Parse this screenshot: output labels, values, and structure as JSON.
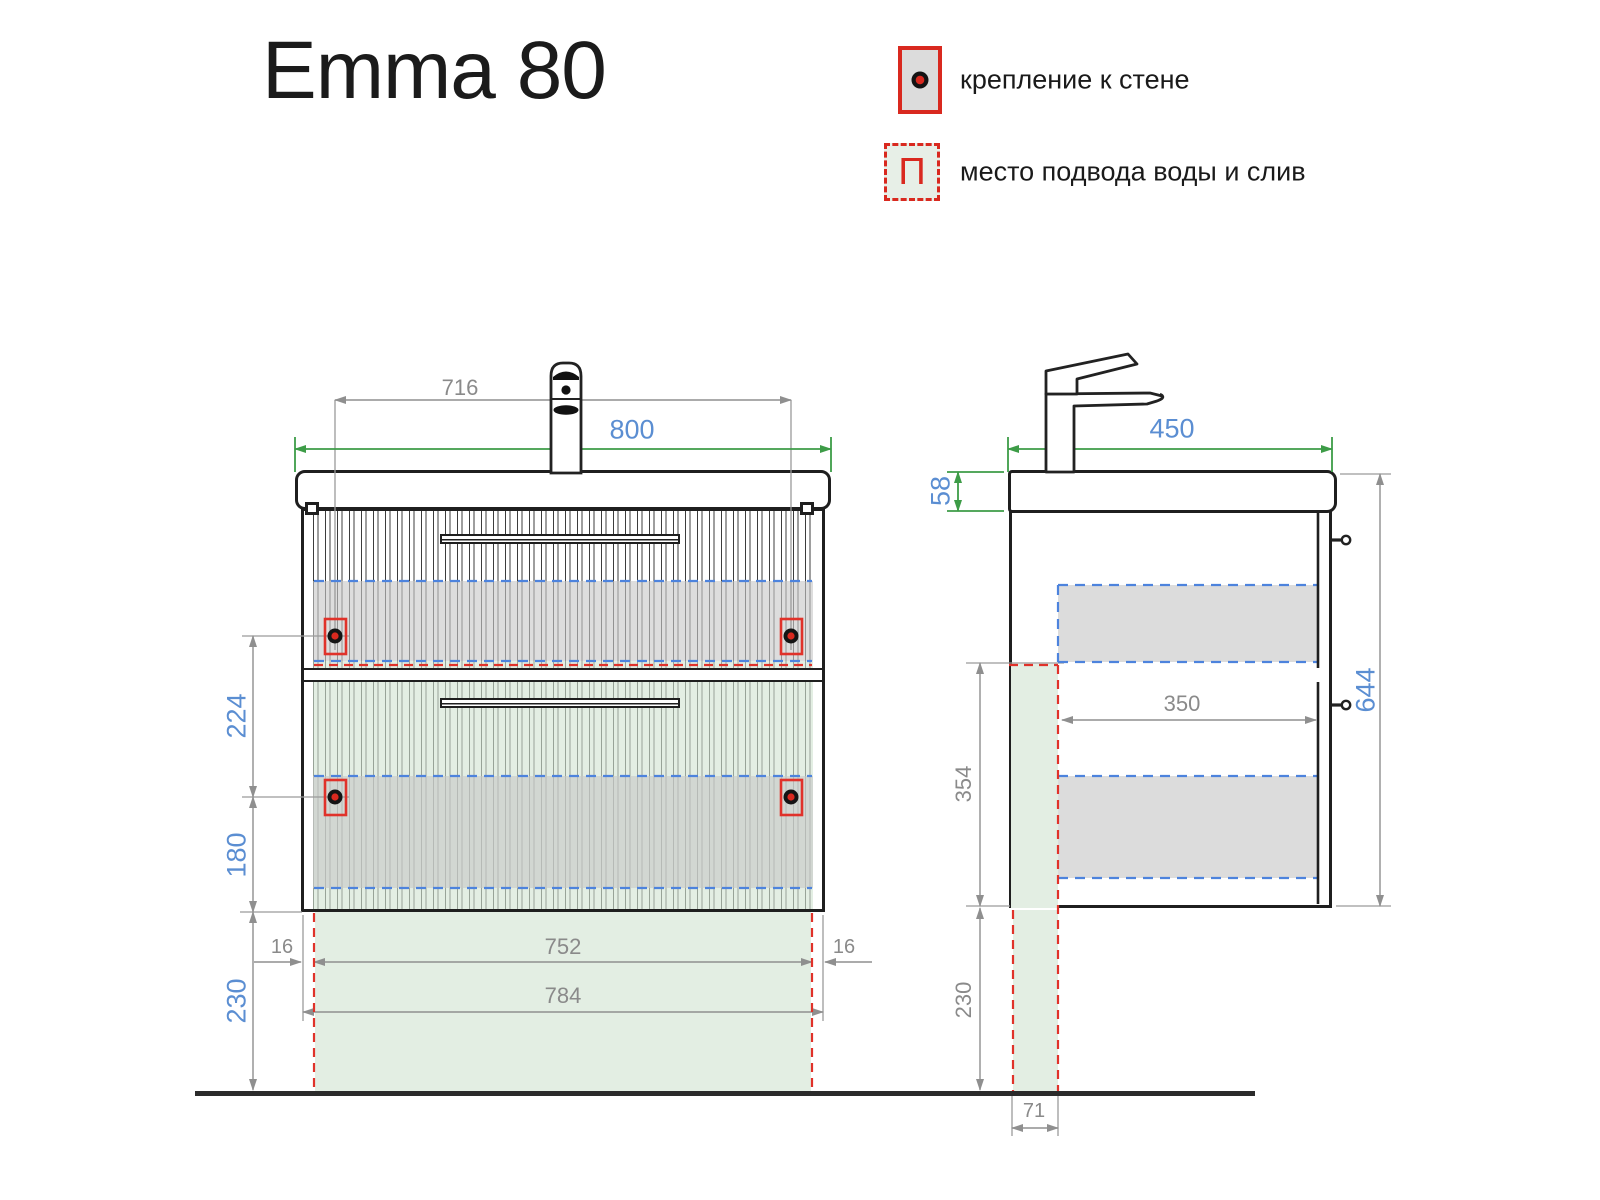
{
  "title": "Emma 80",
  "legend": {
    "wall_mount": {
      "label": "крепление к стене"
    },
    "water": {
      "label": "место подвода воды и слив",
      "symbol": "П"
    }
  },
  "front_view": {
    "dims": {
      "faucet_span": "716",
      "total_width": "800",
      "mount_vertical_gap": "224",
      "mount_to_bottom": "180",
      "floor_clearance": "230",
      "side_inset_left": "16",
      "side_inset_right": "16",
      "inner_width": "752",
      "carcass_width": "784"
    }
  },
  "side_view": {
    "dims": {
      "depth": "450",
      "basin_height": "58",
      "total_height": "644",
      "service_zone_height": "354",
      "floor_clearance": "230",
      "inner_depth": "350",
      "service_strip_width": "71"
    }
  },
  "colors": {
    "accent_red": "#d9291f",
    "dim_blue": "#5b8ed2",
    "dim_green": "#3d9c47",
    "dim_gray": "#8f8f8f",
    "dash_blue": "#4d83dd",
    "line_dark": "#1f1f1f",
    "band_gray": "#dcdcdc",
    "zone_green": "#e3eee3"
  }
}
